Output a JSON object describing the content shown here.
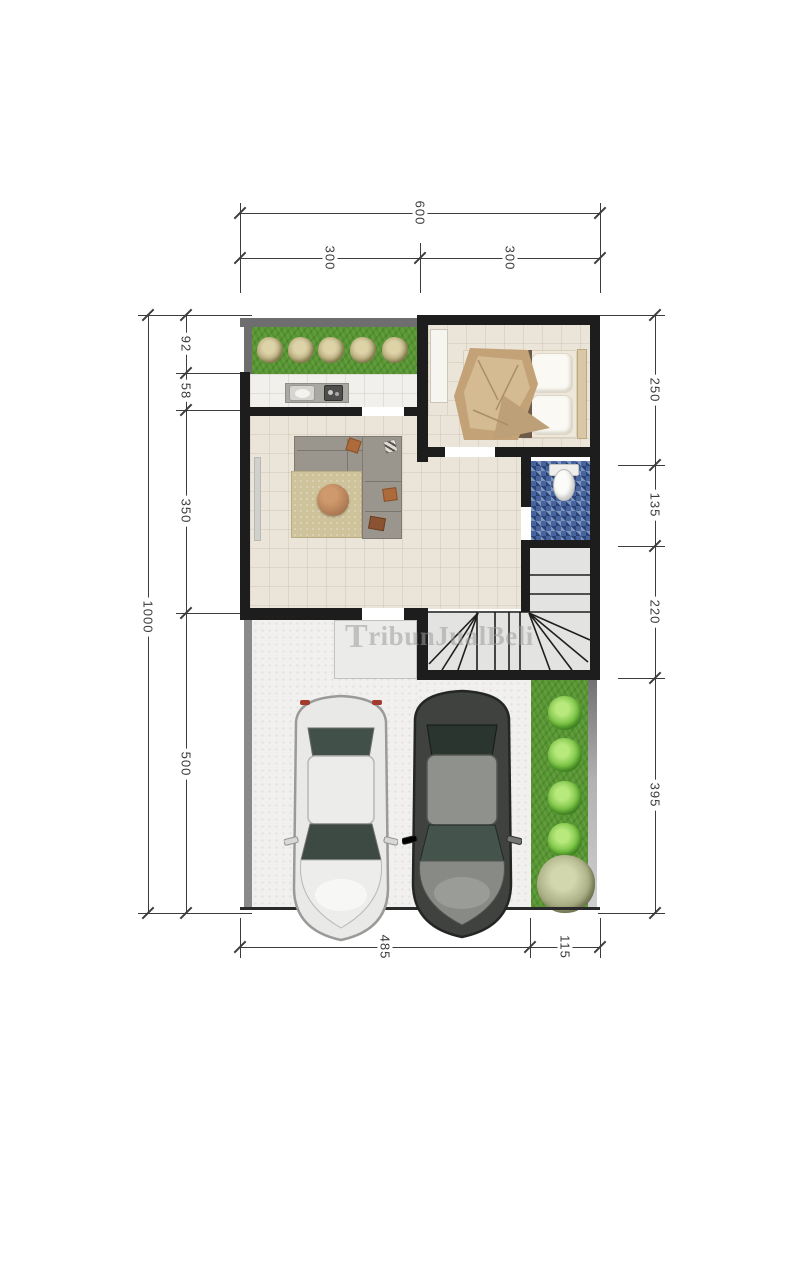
{
  "dimensions": {
    "top": {
      "total": "600",
      "segments": [
        "300",
        "300"
      ]
    },
    "left": {
      "total": "1000",
      "segments": [
        "92",
        "58",
        "350",
        "500"
      ]
    },
    "right": {
      "segments": [
        "250",
        "135",
        "220",
        "395"
      ]
    },
    "bottom": {
      "segments": [
        "485",
        "115"
      ]
    }
  },
  "watermark": {
    "initial": "T",
    "rest": "ribunJualBeli"
  },
  "colors": {
    "dim_line": "#3c3c3c",
    "wall": "#1d1d1d",
    "wall_gray": "#6e6e6e",
    "wall_gray_light": "#8a8a8a",
    "grass": "#579531",
    "bush_green": "#72bd3e",
    "bush_sage": "#a6aa80",
    "bush_tan": "#b3a878",
    "floor_beige": "#eae5d8",
    "floor_light": "#f1f0ec",
    "bath_blue": "#46659e",
    "rug": "#cec39a",
    "table_copper": "#b5815a",
    "sofa": "#9a968e",
    "car_white": "#e9e9e7",
    "car_dark": "#474a47"
  }
}
